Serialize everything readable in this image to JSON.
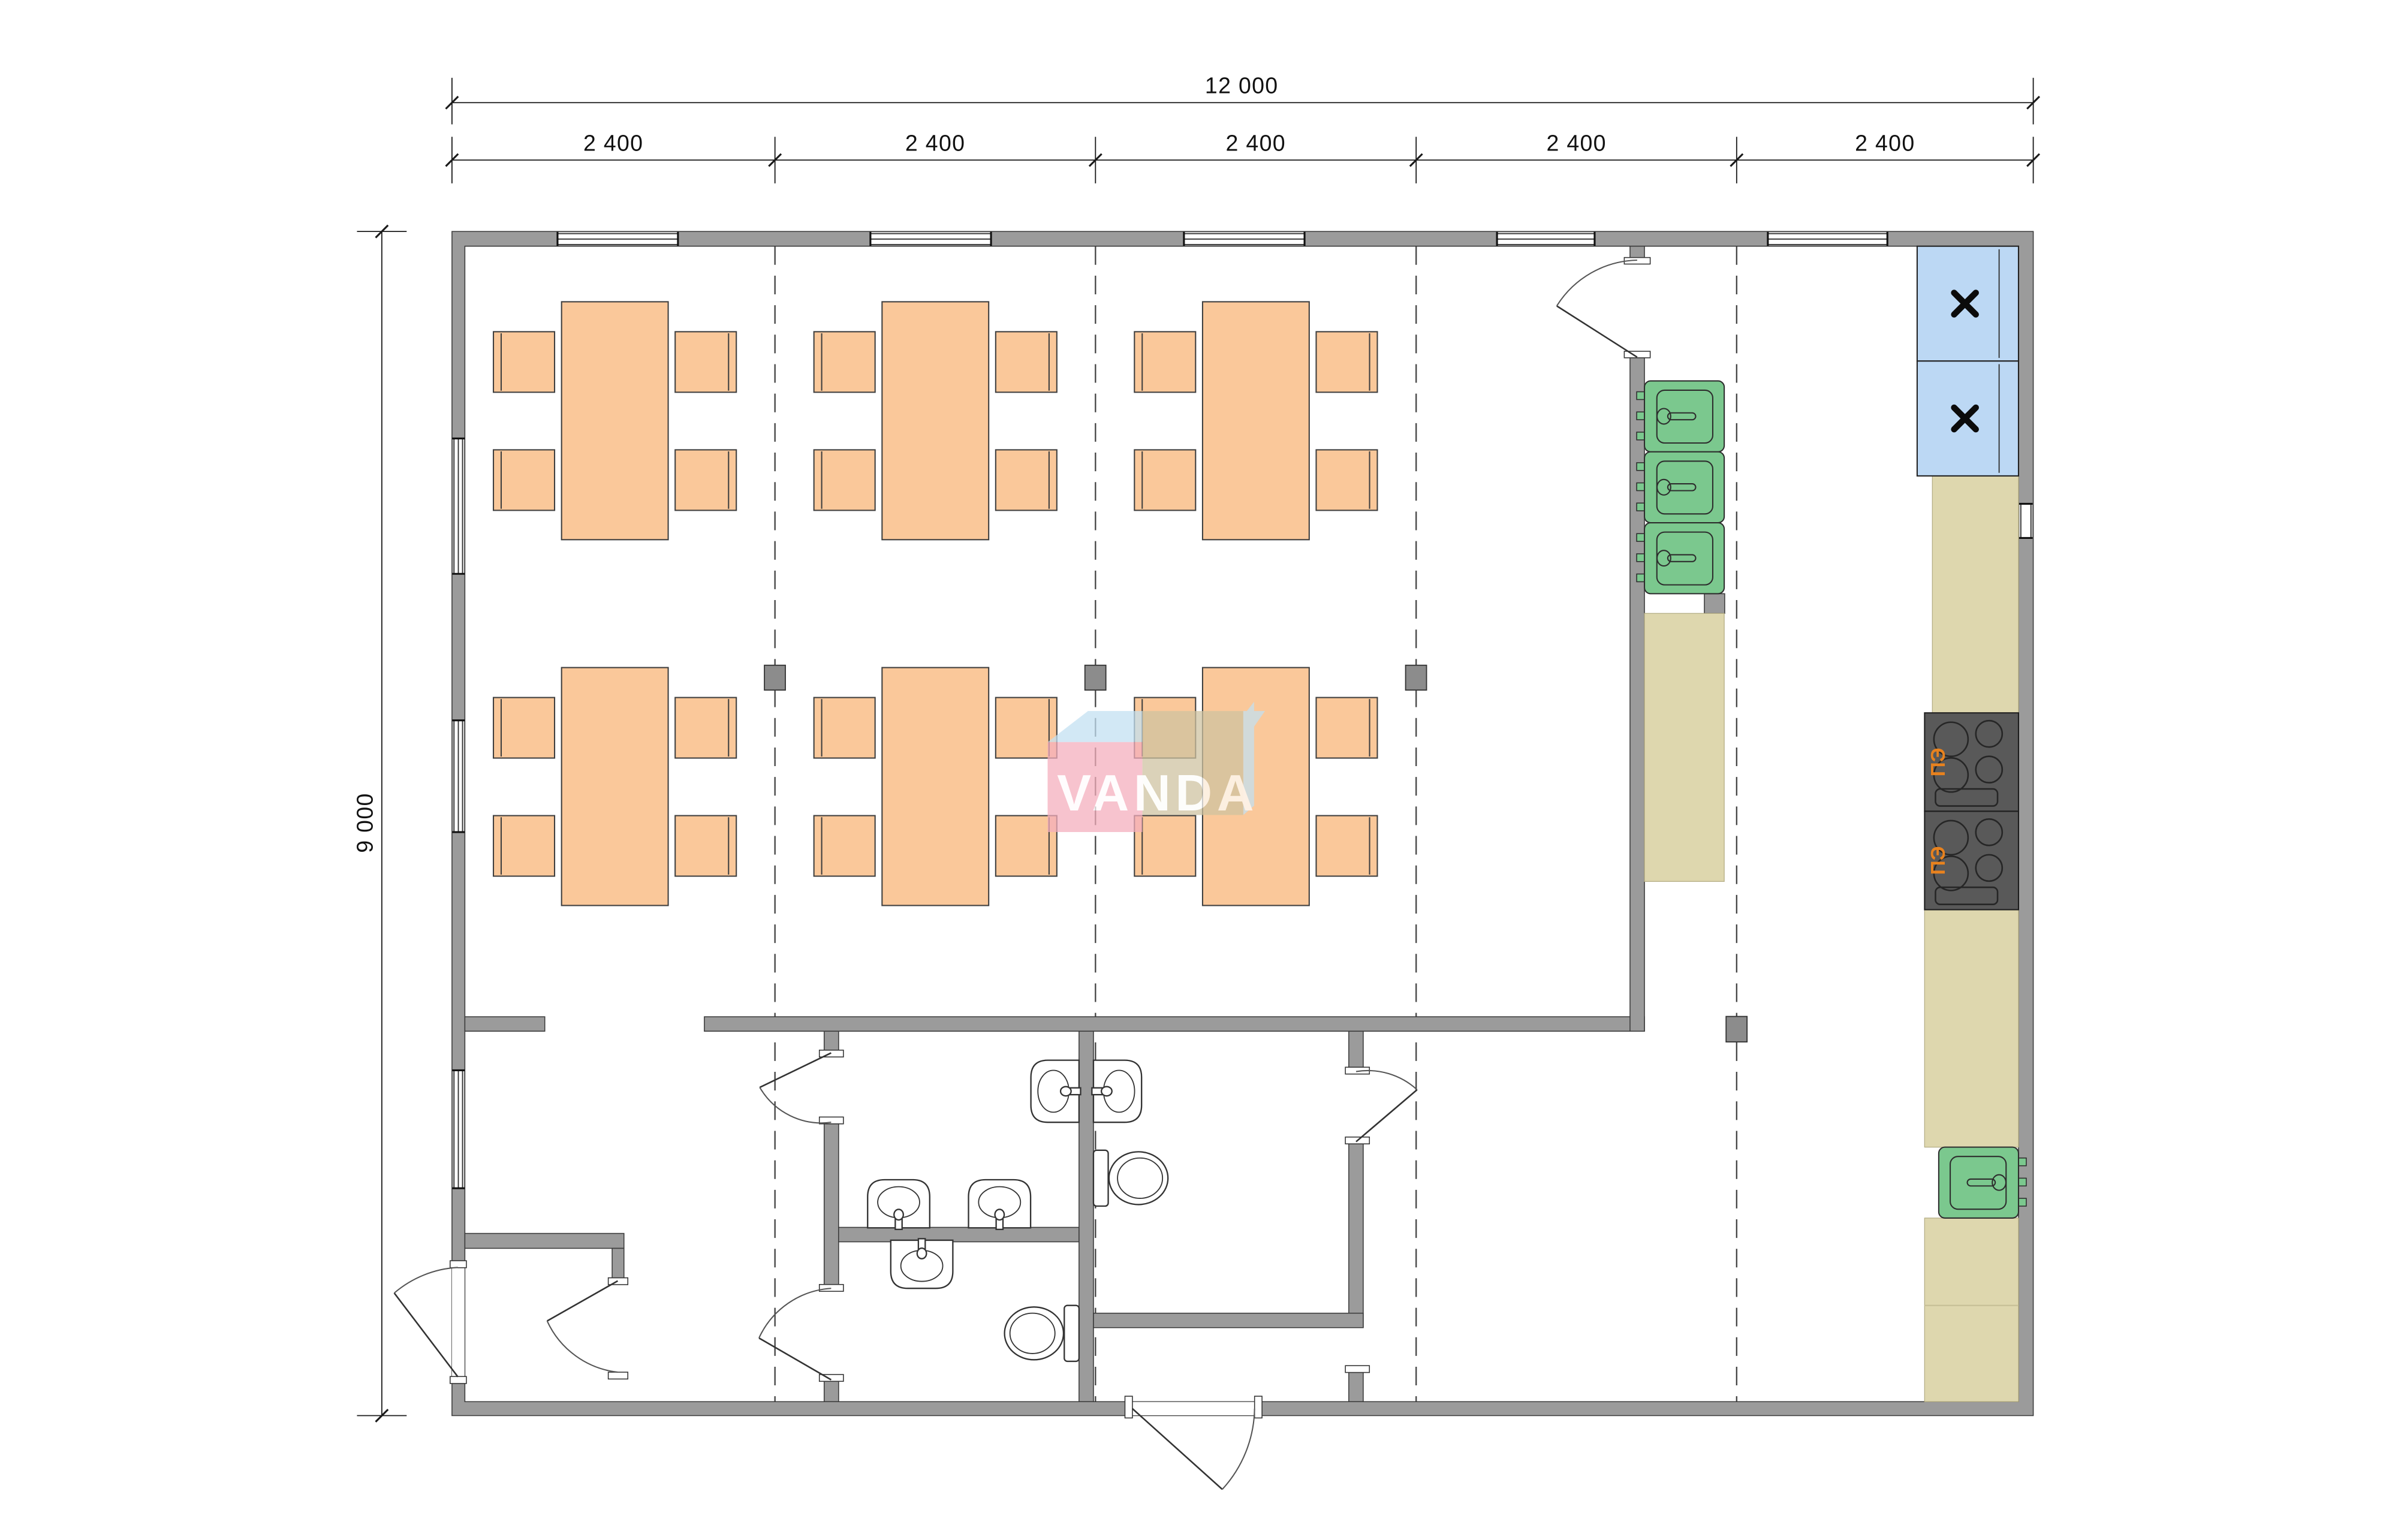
{
  "dimensions": {
    "total_width": "12 000",
    "total_height": "9 000",
    "modules": [
      "2 400",
      "2 400",
      "2 400",
      "2 400",
      "2 400"
    ]
  },
  "watermark": {
    "text": "VANDA"
  },
  "stoves": [
    {
      "label": "ПЭ"
    },
    {
      "label": "ПЭ"
    }
  ],
  "fixtures_visible": {
    "dining_tables": 6,
    "chairs_per_table": 4,
    "refrigerators": 2,
    "kitchen_sink_units": 3,
    "single_sink_units": 1,
    "electric_stoves": 2,
    "wash_basins": 5,
    "toilets": 2,
    "structural_columns": 4
  },
  "icon_names": [
    "fridge-x-icon",
    "faucet-icon",
    "door-swing-icon",
    "burner-icon"
  ],
  "colors": {
    "wall": "#9b9b9b",
    "furniture_peach": "#fac89a",
    "fridge_blue": "#bcd8f4",
    "counter_beige": "#ded7ae",
    "sink_green": "#7bc88e",
    "stove_gray": "#595959",
    "stove_label_orange": "#e8821e",
    "watermark_pink": "#f5aebd",
    "watermark_blue": "#c2e0f2",
    "watermark_beige": "#cfc3a0"
  }
}
